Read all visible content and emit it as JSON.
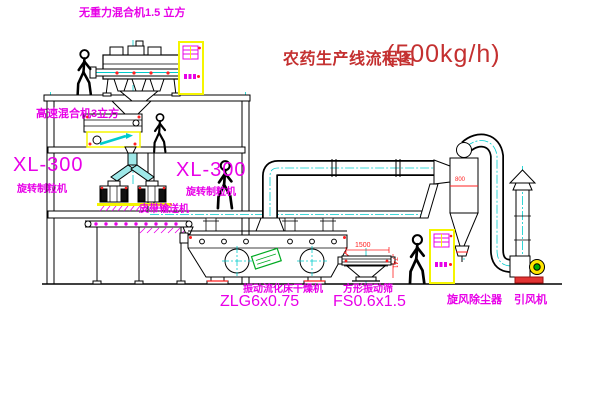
{
  "title": {
    "name_cn": "农药生产线流程图",
    "capacity": "(500kg/h)"
  },
  "labels": {
    "top_mixer": "无重力混合机1.5 立方",
    "high_speed_mixer": "高速混合机3立方",
    "granulator_model_left": "XL-300",
    "granulator_name_left": "旋转制粒机",
    "granulator_model_center": "XL-300",
    "granulator_name_center": "旋转制粒机",
    "belt_conveyor": "皮带输送机",
    "dryer_name": "振动流化床干燥机",
    "dryer_model": "ZLG6x0.75",
    "sieve_name": "方形振动筛",
    "sieve_model": "FS0.6x1.5",
    "cyclone": "旋风除尘器",
    "fan": "引风机"
  },
  "dimensions": {
    "sieve_length": "1500",
    "sieve_height": "741",
    "cyclone_diameter": "800"
  },
  "colors": {
    "label_magenta": "#e800e8",
    "title_red": "#c43030",
    "dimension_red": "#ff2020",
    "cabinet_yellow": "#f5f500",
    "centerline_cyan": "#00cccc",
    "sticker_green": "#00aa22"
  }
}
